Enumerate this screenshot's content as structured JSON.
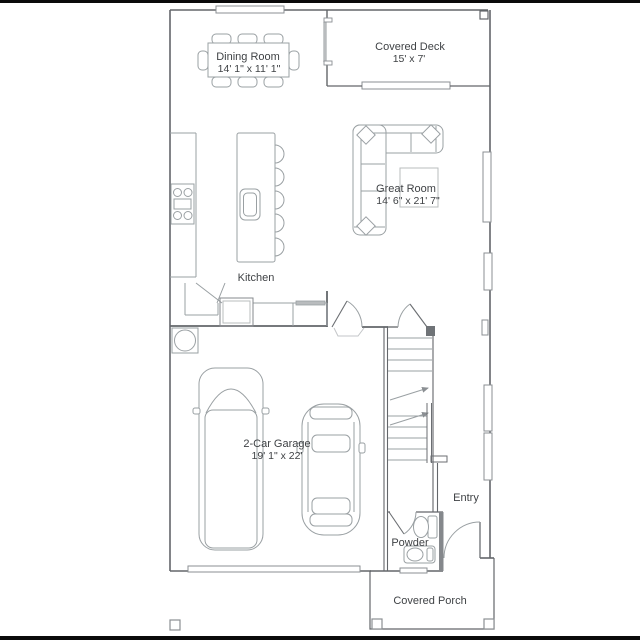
{
  "rooms": {
    "dining_room": {
      "name": "Dining Room",
      "dimensions": "14' 1\" x 11' 1\""
    },
    "covered_deck": {
      "name": "Covered Deck",
      "dimensions": "15' x 7'"
    },
    "great_room": {
      "name": "Great Room",
      "dimensions": "14' 6\" x 21' 7\""
    },
    "kitchen": {
      "name": "Kitchen"
    },
    "garage": {
      "name": "2-Car Garage",
      "dimensions": "19' 1\" x 22'"
    },
    "entry": {
      "name": "Entry"
    },
    "powder": {
      "name": "Powder"
    },
    "covered_porch": {
      "name": "Covered Porch"
    }
  },
  "colors": {
    "background": "#ffffff",
    "wall_line": "#63666a",
    "furniture_line": "#9aa0a3",
    "text": "#3f4245",
    "letterbox_bar": "#0a0a0a"
  }
}
